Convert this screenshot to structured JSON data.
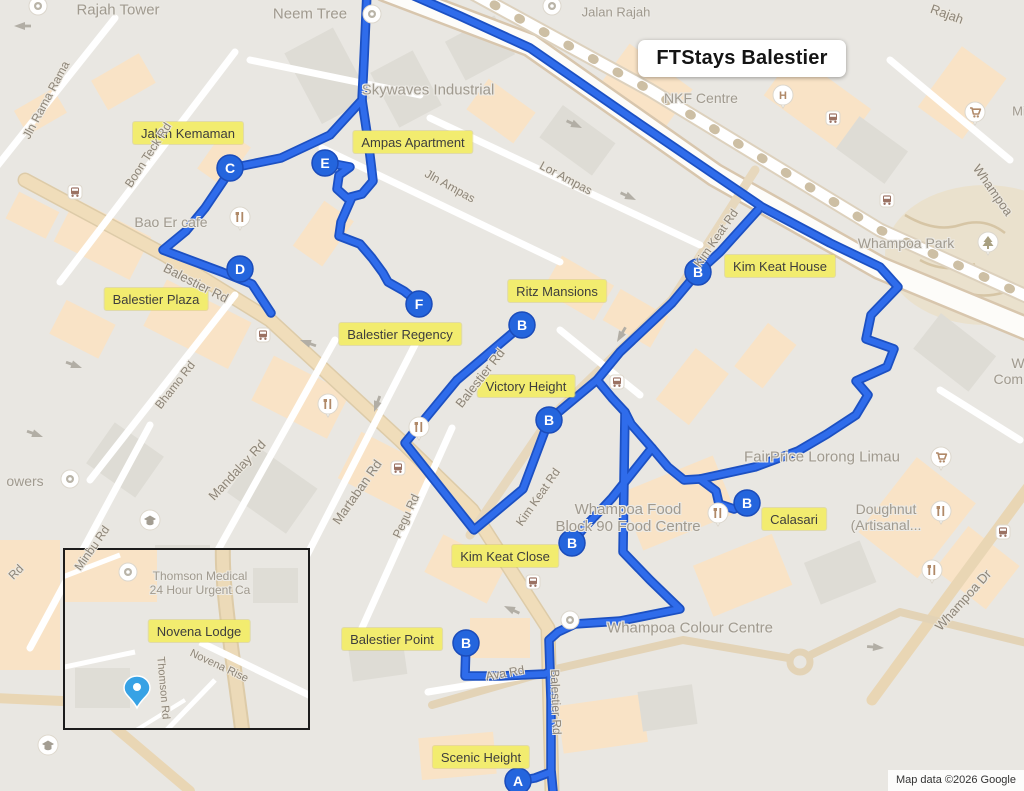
{
  "title": {
    "text": "FTStays Balestier"
  },
  "attribution": {
    "text": "Map data ©2026 Google"
  },
  "map": {
    "colors": {
      "route": "#2f6ceb",
      "route_casing": "#1c50c2",
      "marker_fill": "#2465dd",
      "marker_ring": "#1b4cba",
      "label_bg": "#f2ec6f",
      "pin_blue": "#37a2e5",
      "poi_glyph": "#b08968"
    },
    "routes": [
      {
        "points": [
          [
            405,
            -8
          ],
          [
            460,
            16
          ],
          [
            530,
            48
          ],
          [
            640,
            124
          ],
          [
            712,
            173
          ],
          [
            762,
            207
          ],
          [
            830,
            243
          ],
          [
            880,
            267
          ],
          [
            898,
            287
          ],
          [
            871,
            315
          ],
          [
            866,
            339
          ],
          [
            894,
            349
          ],
          [
            887,
            367
          ],
          [
            856,
            381
          ],
          [
            868,
            395
          ],
          [
            856,
            415
          ],
          [
            827,
            434
          ],
          [
            798,
            451
          ],
          [
            755,
            467
          ],
          [
            700,
            479
          ],
          [
            716,
            491
          ],
          [
            719,
            504
          ],
          [
            734,
            509
          ],
          [
            747,
            503
          ]
        ]
      },
      {
        "points": [
          [
            758,
            210
          ],
          [
            720,
            252
          ],
          [
            698,
            272
          ]
        ]
      },
      {
        "points": [
          [
            698,
            272
          ],
          [
            672,
            303
          ],
          [
            620,
            352
          ],
          [
            597,
            380
          ],
          [
            549,
            420
          ],
          [
            523,
            489
          ],
          [
            474,
            530
          ],
          [
            405,
            443
          ],
          [
            457,
            380
          ],
          [
            522,
            325
          ]
        ]
      },
      {
        "points": [
          [
            597,
            380
          ],
          [
            612,
            398
          ],
          [
            625,
            412
          ],
          [
            631,
            424
          ],
          [
            652,
            448
          ],
          [
            668,
            467
          ],
          [
            684,
            480
          ],
          [
            700,
            479
          ]
        ]
      },
      {
        "points": [
          [
            625,
            412
          ],
          [
            624,
            480
          ],
          [
            623,
            552
          ],
          [
            650,
            580
          ],
          [
            680,
            609
          ],
          [
            620,
            621
          ],
          [
            575,
            624
          ],
          [
            558,
            632
          ],
          [
            549,
            640
          ],
          [
            551,
            700
          ],
          [
            551,
            770
          ],
          [
            553,
            791
          ]
        ]
      },
      {
        "points": [
          [
            551,
            772
          ],
          [
            535,
            778
          ],
          [
            518,
            781
          ]
        ]
      },
      {
        "points": [
          [
            652,
            448
          ],
          [
            612,
            498
          ],
          [
            583,
            529
          ],
          [
            572,
            543
          ]
        ]
      },
      {
        "points": [
          [
            466,
            643
          ],
          [
            465,
            676
          ],
          [
            500,
            676
          ],
          [
            545,
            674
          ],
          [
            549,
            672
          ]
        ]
      },
      {
        "points": [
          [
            367,
            -8
          ],
          [
            364,
            60
          ],
          [
            362,
            100
          ],
          [
            330,
            135
          ],
          [
            281,
            158
          ],
          [
            232,
            168
          ],
          [
            205,
            208
          ],
          [
            186,
            231
          ],
          [
            163,
            250
          ],
          [
            222,
            272
          ],
          [
            252,
            284
          ],
          [
            271,
            313
          ]
        ]
      },
      {
        "points": [
          [
            362,
            100
          ],
          [
            368,
            140
          ],
          [
            371,
            164
          ],
          [
            373,
            181
          ],
          [
            362,
            194
          ],
          [
            347,
            198
          ],
          [
            337,
            189
          ],
          [
            339,
            175
          ],
          [
            350,
            167
          ],
          [
            329,
            163
          ]
        ]
      },
      {
        "points": [
          [
            352,
            197
          ],
          [
            341,
            222
          ],
          [
            339,
            236
          ],
          [
            360,
            244
          ],
          [
            372,
            258
          ],
          [
            383,
            273
          ],
          [
            388,
            282
          ],
          [
            404,
            291
          ],
          [
            414,
            299
          ],
          [
            419,
            304
          ]
        ]
      }
    ],
    "markers": [
      {
        "letter": "A",
        "x": 518,
        "y": 781
      },
      {
        "letter": "B",
        "x": 522,
        "y": 325
      },
      {
        "letter": "B",
        "x": 698,
        "y": 272
      },
      {
        "letter": "B",
        "x": 549,
        "y": 420
      },
      {
        "letter": "B",
        "x": 747,
        "y": 503
      },
      {
        "letter": "B",
        "x": 572,
        "y": 543
      },
      {
        "letter": "B",
        "x": 466,
        "y": 643
      },
      {
        "letter": "C",
        "x": 230,
        "y": 168
      },
      {
        "letter": "D",
        "x": 240,
        "y": 269
      },
      {
        "letter": "E",
        "x": 325,
        "y": 163
      },
      {
        "letter": "F",
        "x": 419,
        "y": 304
      }
    ],
    "place_labels": [
      {
        "text": "Jalan Kemaman",
        "x": 188,
        "y": 133
      },
      {
        "text": "Ampas Apartment",
        "x": 413,
        "y": 142
      },
      {
        "text": "Kim Keat House",
        "x": 780,
        "y": 266
      },
      {
        "text": "Balestier Plaza",
        "x": 156,
        "y": 299
      },
      {
        "text": "Ritz Mansions",
        "x": 557,
        "y": 291
      },
      {
        "text": "Balestier Regency",
        "x": 400,
        "y": 334
      },
      {
        "text": "Victory Height",
        "x": 526,
        "y": 386
      },
      {
        "text": "Calasari",
        "x": 794,
        "y": 519
      },
      {
        "text": "Kim Keat Close",
        "x": 505,
        "y": 556
      },
      {
        "text": "Balestier Point",
        "x": 392,
        "y": 639
      },
      {
        "text": "Novena Lodge",
        "x": 199,
        "y": 631
      },
      {
        "text": "Scenic Height",
        "x": 481,
        "y": 757
      }
    ],
    "poi_labels": [
      {
        "text": "Rajah Tower",
        "x": 118,
        "y": 10,
        "size": 15
      },
      {
        "text": "Neem Tree",
        "x": 310,
        "y": 14,
        "size": 15
      },
      {
        "text": "Jalan Rajah",
        "x": 616,
        "y": 13,
        "size": 13
      },
      {
        "text": "Skywaves Industrial",
        "x": 428,
        "y": 90,
        "size": 15
      },
      {
        "text": "NKF Centre",
        "x": 701,
        "y": 98,
        "size": 14
      },
      {
        "text": "Whampoa Park",
        "x": 906,
        "y": 243,
        "size": 14
      },
      {
        "text": "Bao Er cafe",
        "x": 171,
        "y": 222,
        "size": 14
      },
      {
        "text": "FairPrice Lorong Limau",
        "x": 822,
        "y": 457,
        "size": 15
      },
      {
        "lines": [
          "Doughnut",
          "(Artisanal..."
        ],
        "x": 886,
        "y": 517,
        "size": 14
      },
      {
        "lines": [
          "Whampoa Food",
          "Block 90 Food Centre"
        ],
        "x": 628,
        "y": 518,
        "size": 15
      },
      {
        "text": "Whampoa Colour Centre",
        "x": 690,
        "y": 628,
        "size": 15
      },
      {
        "text": "owers",
        "x": 25,
        "y": 481,
        "size": 14
      },
      {
        "lines": [
          "W",
          "Commu"
        ],
        "x": 1018,
        "y": 371,
        "size": 14
      },
      {
        "text": "Mi",
        "x": 1019,
        "y": 112,
        "size": 13
      },
      {
        "lines": [
          "Thomson Medical",
          "24 Hour Urgent Ca"
        ],
        "x": 200,
        "y": 584,
        "size": 12
      }
    ],
    "road_labels": [
      {
        "text": "Jln Rama Rama",
        "x": 46,
        "y": 100,
        "rot": -62,
        "size": 12
      },
      {
        "text": "Boon Teck Rd",
        "x": 148,
        "y": 155,
        "rot": -57,
        "size": 12
      },
      {
        "text": "Balestier Rd",
        "x": 196,
        "y": 283,
        "rot": 27,
        "size": 13
      },
      {
        "text": "Bhamo Rd",
        "x": 175,
        "y": 385,
        "rot": -52,
        "size": 12
      },
      {
        "text": "Mandalay Rd",
        "x": 237,
        "y": 470,
        "rot": -47,
        "size": 13
      },
      {
        "text": "Minbu Rd",
        "x": 92,
        "y": 548,
        "rot": -55,
        "size": 12
      },
      {
        "text": "Martaban Rd",
        "x": 357,
        "y": 492,
        "rot": -55,
        "size": 13
      },
      {
        "text": "Pegu Rd",
        "x": 406,
        "y": 516,
        "rot": -65,
        "size": 12
      },
      {
        "text": "Ava Rd",
        "x": 505,
        "y": 673,
        "rot": -10,
        "size": 12
      },
      {
        "text": "Balestier Rd",
        "x": 556,
        "y": 702,
        "rot": 88,
        "size": 12
      },
      {
        "text": "Balestier Rd",
        "x": 480,
        "y": 378,
        "rot": -52,
        "size": 13
      },
      {
        "text": "Kim Keat Rd",
        "x": 716,
        "y": 238,
        "rot": -55,
        "size": 12
      },
      {
        "text": "Kim Keat Rd",
        "x": 538,
        "y": 497,
        "rot": -55,
        "size": 12
      },
      {
        "text": "Jln Ampas",
        "x": 450,
        "y": 186,
        "rot": 29,
        "size": 12
      },
      {
        "text": "Lor Ampas",
        "x": 566,
        "y": 178,
        "rot": 28,
        "size": 12
      },
      {
        "text": "Whampoa Dr",
        "x": 963,
        "y": 600,
        "rot": -48,
        "size": 13
      },
      {
        "text": "Whampoa",
        "x": 993,
        "y": 190,
        "rot": 55,
        "size": 13
      },
      {
        "text": "Rajah",
        "x": 947,
        "y": 14,
        "rot": 20,
        "size": 13
      },
      {
        "text": "Rd",
        "x": 16,
        "y": 572,
        "rot": -45,
        "size": 12
      },
      {
        "text": "Novena Rise",
        "x": 219,
        "y": 666,
        "rot": 25,
        "size": 11
      },
      {
        "text": "Thomson Rd",
        "x": 163,
        "y": 688,
        "rot": 85,
        "size": 11
      }
    ],
    "pois": [
      {
        "type": "generic",
        "x": 38,
        "y": 6
      },
      {
        "type": "generic",
        "x": 552,
        "y": 6
      },
      {
        "type": "generic",
        "x": 372,
        "y": 14
      },
      {
        "type": "generic",
        "x": 70,
        "y": 479
      },
      {
        "type": "generic",
        "x": 570,
        "y": 620
      },
      {
        "type": "generic",
        "x": 128,
        "y": 572
      },
      {
        "type": "restaurant",
        "x": 240,
        "y": 217
      },
      {
        "type": "restaurant",
        "x": 328,
        "y": 404
      },
      {
        "type": "restaurant",
        "x": 419,
        "y": 427
      },
      {
        "type": "restaurant",
        "x": 718,
        "y": 513
      },
      {
        "type": "restaurant",
        "x": 941,
        "y": 511
      },
      {
        "type": "restaurant",
        "x": 932,
        "y": 570
      },
      {
        "type": "bus",
        "x": 75,
        "y": 192
      },
      {
        "type": "bus",
        "x": 833,
        "y": 118
      },
      {
        "type": "bus",
        "x": 887,
        "y": 200
      },
      {
        "type": "bus",
        "x": 263,
        "y": 335
      },
      {
        "type": "bus",
        "x": 398,
        "y": 468
      },
      {
        "type": "bus",
        "x": 617,
        "y": 382
      },
      {
        "type": "bus",
        "x": 533,
        "y": 582
      },
      {
        "type": "bus",
        "x": 1003,
        "y": 532
      },
      {
        "type": "hospital",
        "x": 783,
        "y": 95
      },
      {
        "type": "cart",
        "x": 975,
        "y": 112
      },
      {
        "type": "cart",
        "x": 941,
        "y": 457
      },
      {
        "type": "park",
        "x": 988,
        "y": 242
      },
      {
        "type": "gradcap",
        "x": 150,
        "y": 520
      },
      {
        "type": "gradcap",
        "x": 48,
        "y": 745
      },
      {
        "type": "pin-blue",
        "x": 137,
        "y": 689
      }
    ]
  }
}
